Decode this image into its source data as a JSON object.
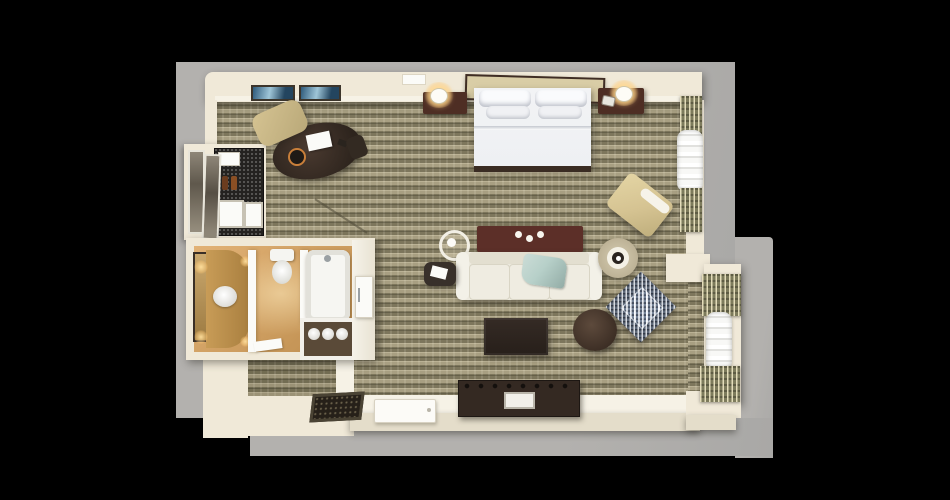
{
  "scene": {
    "kind": "3d-floorplan-top-view",
    "subject": "hotel-guest-room-suite"
  },
  "palette": {
    "background": "#000000",
    "matte": "#b3b1ae",
    "matte_dark": "#a9a8a6",
    "wall": "#f0e9d8",
    "wall_bright": "#f6f2e6",
    "wall_shade": "#e4ddca",
    "carpet_base": "#948d70",
    "carpet_light": "#a89f82",
    "carpet_dark": "#7d765c",
    "entry_carpet": "#857f64",
    "bath_floor_light": "#e2b276",
    "bath_floor_dark": "#bd8d4e",
    "wood_dark": "#342922",
    "wood_red": "#4e2e24",
    "maroon": "#5c2f28",
    "sofa_cream": "#edeadf",
    "bed_white": "#eef0f3",
    "headboard_tan": "#d9cda6",
    "chair_tan": "#d5c392",
    "throw_teal": "#b7d0c9",
    "pattern_blue": "#5d6878",
    "drape_olive": "#7d7b5c",
    "granite": "#242220",
    "glow_amber": "#ffcf8a",
    "white": "#fbfbf8",
    "silver": "#9aa0a3"
  },
  "rooms": [
    "bedroom-living-area",
    "bathroom",
    "closet-minibar",
    "entry",
    "window-bay"
  ],
  "furniture": [
    "king-bed",
    "headboard",
    "pillows",
    "nightstand-left",
    "nightstand-right",
    "table-lamp-left",
    "table-lamp-right",
    "telephone",
    "wall-art",
    "desk",
    "desk-chair",
    "guest-chair",
    "desk-lamp",
    "desk-papers",
    "closet-wardrobe",
    "minibar-granite-cabinet",
    "mirrored-closet-doors",
    "vanity-counter",
    "sink",
    "vanity-mirror",
    "vanity-lights",
    "toilet",
    "bathtub",
    "towel-shelf",
    "rolled-towels",
    "bathroom-door",
    "sofa",
    "throw-blanket",
    "console-table",
    "candles",
    "room-service-tray",
    "side-table",
    "coffee-table",
    "tv-console",
    "tv-remote",
    "round-ottoman",
    "patterned-accent-chair",
    "floor-lamp",
    "lounge-chair",
    "sheer-curtains",
    "patterned-drapes",
    "entry-mat",
    "entry-door"
  ]
}
